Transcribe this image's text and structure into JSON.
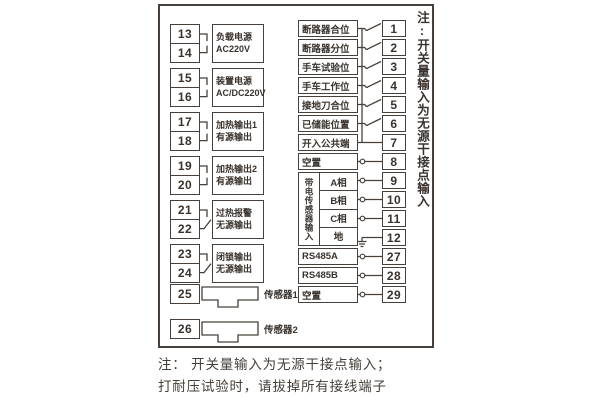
{
  "colors": {
    "line": "#47403a",
    "text": "#39322d",
    "bg": "#ffffff"
  },
  "left_terminal_groups": [
    {
      "terminals": [
        "13",
        "14"
      ],
      "label_lines": [
        "负载电源",
        "AC220V"
      ],
      "connector": "elbow"
    },
    {
      "terminals": [
        "15",
        "16"
      ],
      "label_lines": [
        "装置电源",
        "AC/DC220V"
      ],
      "connector": "elbow"
    },
    {
      "terminals": [
        "17",
        "18"
      ],
      "label_lines": [
        "加热输出1",
        "有源输出"
      ],
      "connector": "elbow"
    },
    {
      "terminals": [
        "19",
        "20"
      ],
      "label_lines": [
        "加热输出2",
        "有源输出"
      ],
      "connector": "elbow"
    },
    {
      "terminals": [
        "21",
        "22"
      ],
      "label_lines": [
        "过热报警",
        "无源输出"
      ],
      "connector": "contact"
    },
    {
      "terminals": [
        "23",
        "24"
      ],
      "label_lines": [
        "闭锁输出",
        "无源输出"
      ],
      "connector": "contact"
    }
  ],
  "sensors": [
    {
      "terminal": "25",
      "label": "传感器1",
      "icon": "sensor-plug-icon"
    },
    {
      "terminal": "26",
      "label": "传感器2",
      "icon": "sensor-plug-icon"
    }
  ],
  "right_rows_top": [
    {
      "label": "断路器合位",
      "terminal": "1",
      "connector": "switch"
    },
    {
      "label": "断路器分位",
      "terminal": "2",
      "connector": "switch"
    },
    {
      "label": "手车试验位",
      "terminal": "3",
      "connector": "switch"
    },
    {
      "label": "手车工作位",
      "terminal": "4",
      "connector": "switch"
    },
    {
      "label": "接地刀合位",
      "terminal": "5",
      "connector": "switch"
    },
    {
      "label": "已储能位置",
      "terminal": "6",
      "connector": "switch"
    },
    {
      "label": "开入公共端",
      "terminal": "7",
      "connector": "line"
    },
    {
      "label": "空置",
      "terminal": "8",
      "connector": "circle"
    }
  ],
  "live_sensor_group": {
    "vertical_label": "带电传感器输入",
    "rows": [
      {
        "label": "A相",
        "terminal": "9",
        "connector": "circle"
      },
      {
        "label": "B相",
        "terminal": "10",
        "connector": "circle"
      },
      {
        "label": "C相",
        "terminal": "11",
        "connector": "circle"
      },
      {
        "label": "地",
        "terminal": "12",
        "connector": "ground"
      }
    ]
  },
  "right_rows_bottom": [
    {
      "label": "RS485A",
      "terminal": "27",
      "connector": "circle"
    },
    {
      "label": "RS485B",
      "terminal": "28",
      "connector": "circle"
    },
    {
      "label": "空置",
      "terminal": "29",
      "connector": "circle"
    }
  ],
  "side_note": "注:开关量输入为无源干接点输入",
  "bottom_notes": [
    "注： 开关量输入为无源干接点输入；",
    "打耐压试验时，请拔掉所有接线端子"
  ]
}
